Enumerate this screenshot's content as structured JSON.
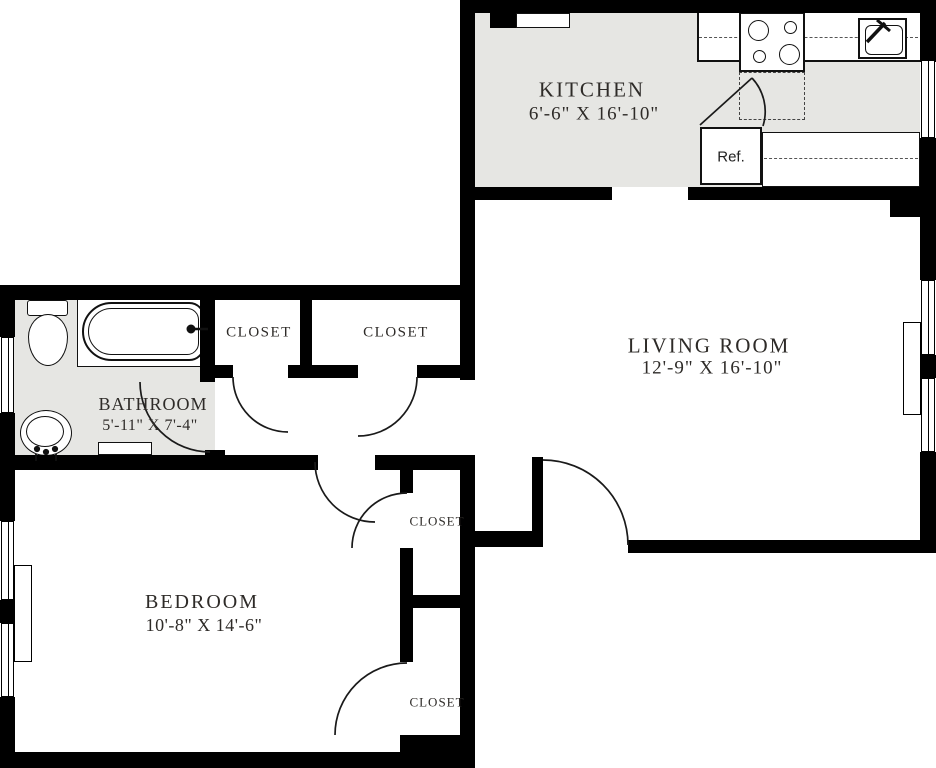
{
  "plan": {
    "title": "One-bedroom apartment floor plan",
    "colors": {
      "wall": "#000000",
      "shaded_floor": "#e6e6e3",
      "text": "#2e2b28",
      "background": "#ffffff"
    }
  },
  "rooms": {
    "kitchen": {
      "name": "KITCHEN",
      "dims": "6'-6\" X 16'-10\""
    },
    "living": {
      "name": "LIVING ROOM",
      "dims": "12'-9\" X 16'-10\""
    },
    "bathroom": {
      "name": "BATHROOM",
      "dims": "5'-11\" X 7'-4\""
    },
    "bedroom": {
      "name": "BEDROOM",
      "dims": "10'-8\" X 14'-6\""
    },
    "closet_hall_left": {
      "name": "CLOSET"
    },
    "closet_hall_right": {
      "name": "CLOSET"
    },
    "closet_bedroom_top": {
      "name": "CLOSET"
    },
    "closet_bedroom_bottom": {
      "name": "CLOSET"
    }
  },
  "fixtures": {
    "refrigerator": {
      "label": "Ref."
    },
    "stove": "4-burner range",
    "kitchen_sink": "kitchen sink",
    "toilet": "toilet",
    "bathtub": "bathtub",
    "bathroom_sink": "basin"
  }
}
